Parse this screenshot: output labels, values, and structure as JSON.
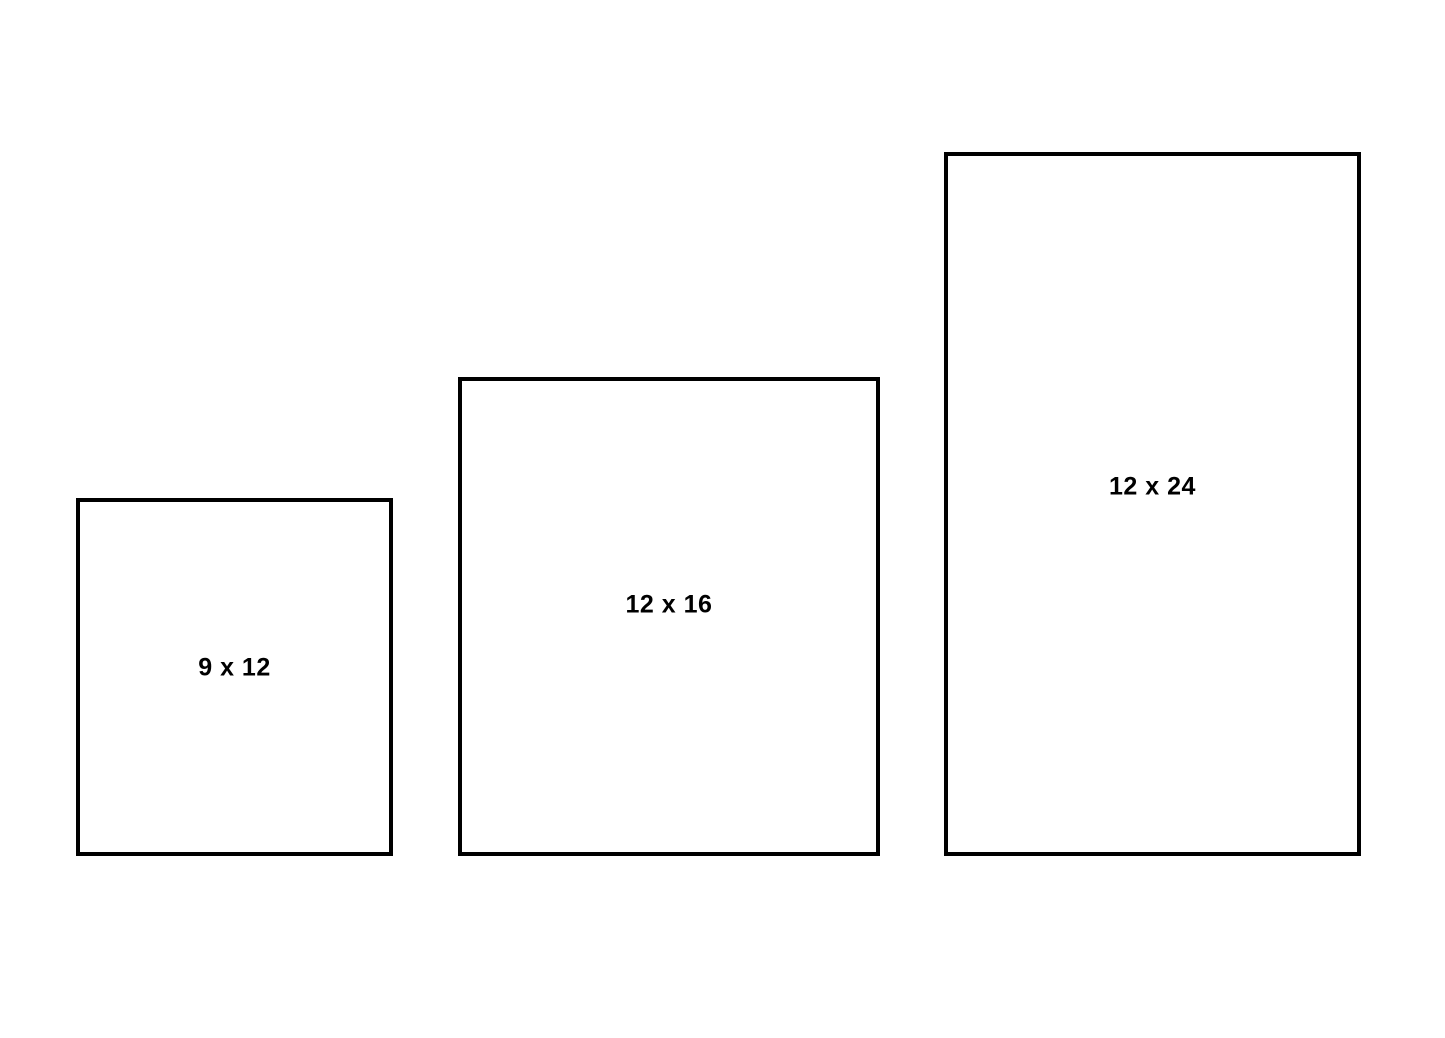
{
  "diagram": {
    "kind": "size-comparison",
    "background_color": "#ffffff",
    "border_color": "#000000",
    "text_color": "#000000"
  },
  "boxes": [
    {
      "label": "9 x 12",
      "rect": {
        "left": 76,
        "top": 498,
        "width": 317,
        "height": 358
      }
    },
    {
      "label": "12 x 16",
      "rect": {
        "left": 458,
        "top": 377,
        "width": 422,
        "height": 479
      }
    },
    {
      "label": "12 x 24",
      "rect": {
        "left": 944,
        "top": 152,
        "width": 417,
        "height": 704
      }
    }
  ]
}
